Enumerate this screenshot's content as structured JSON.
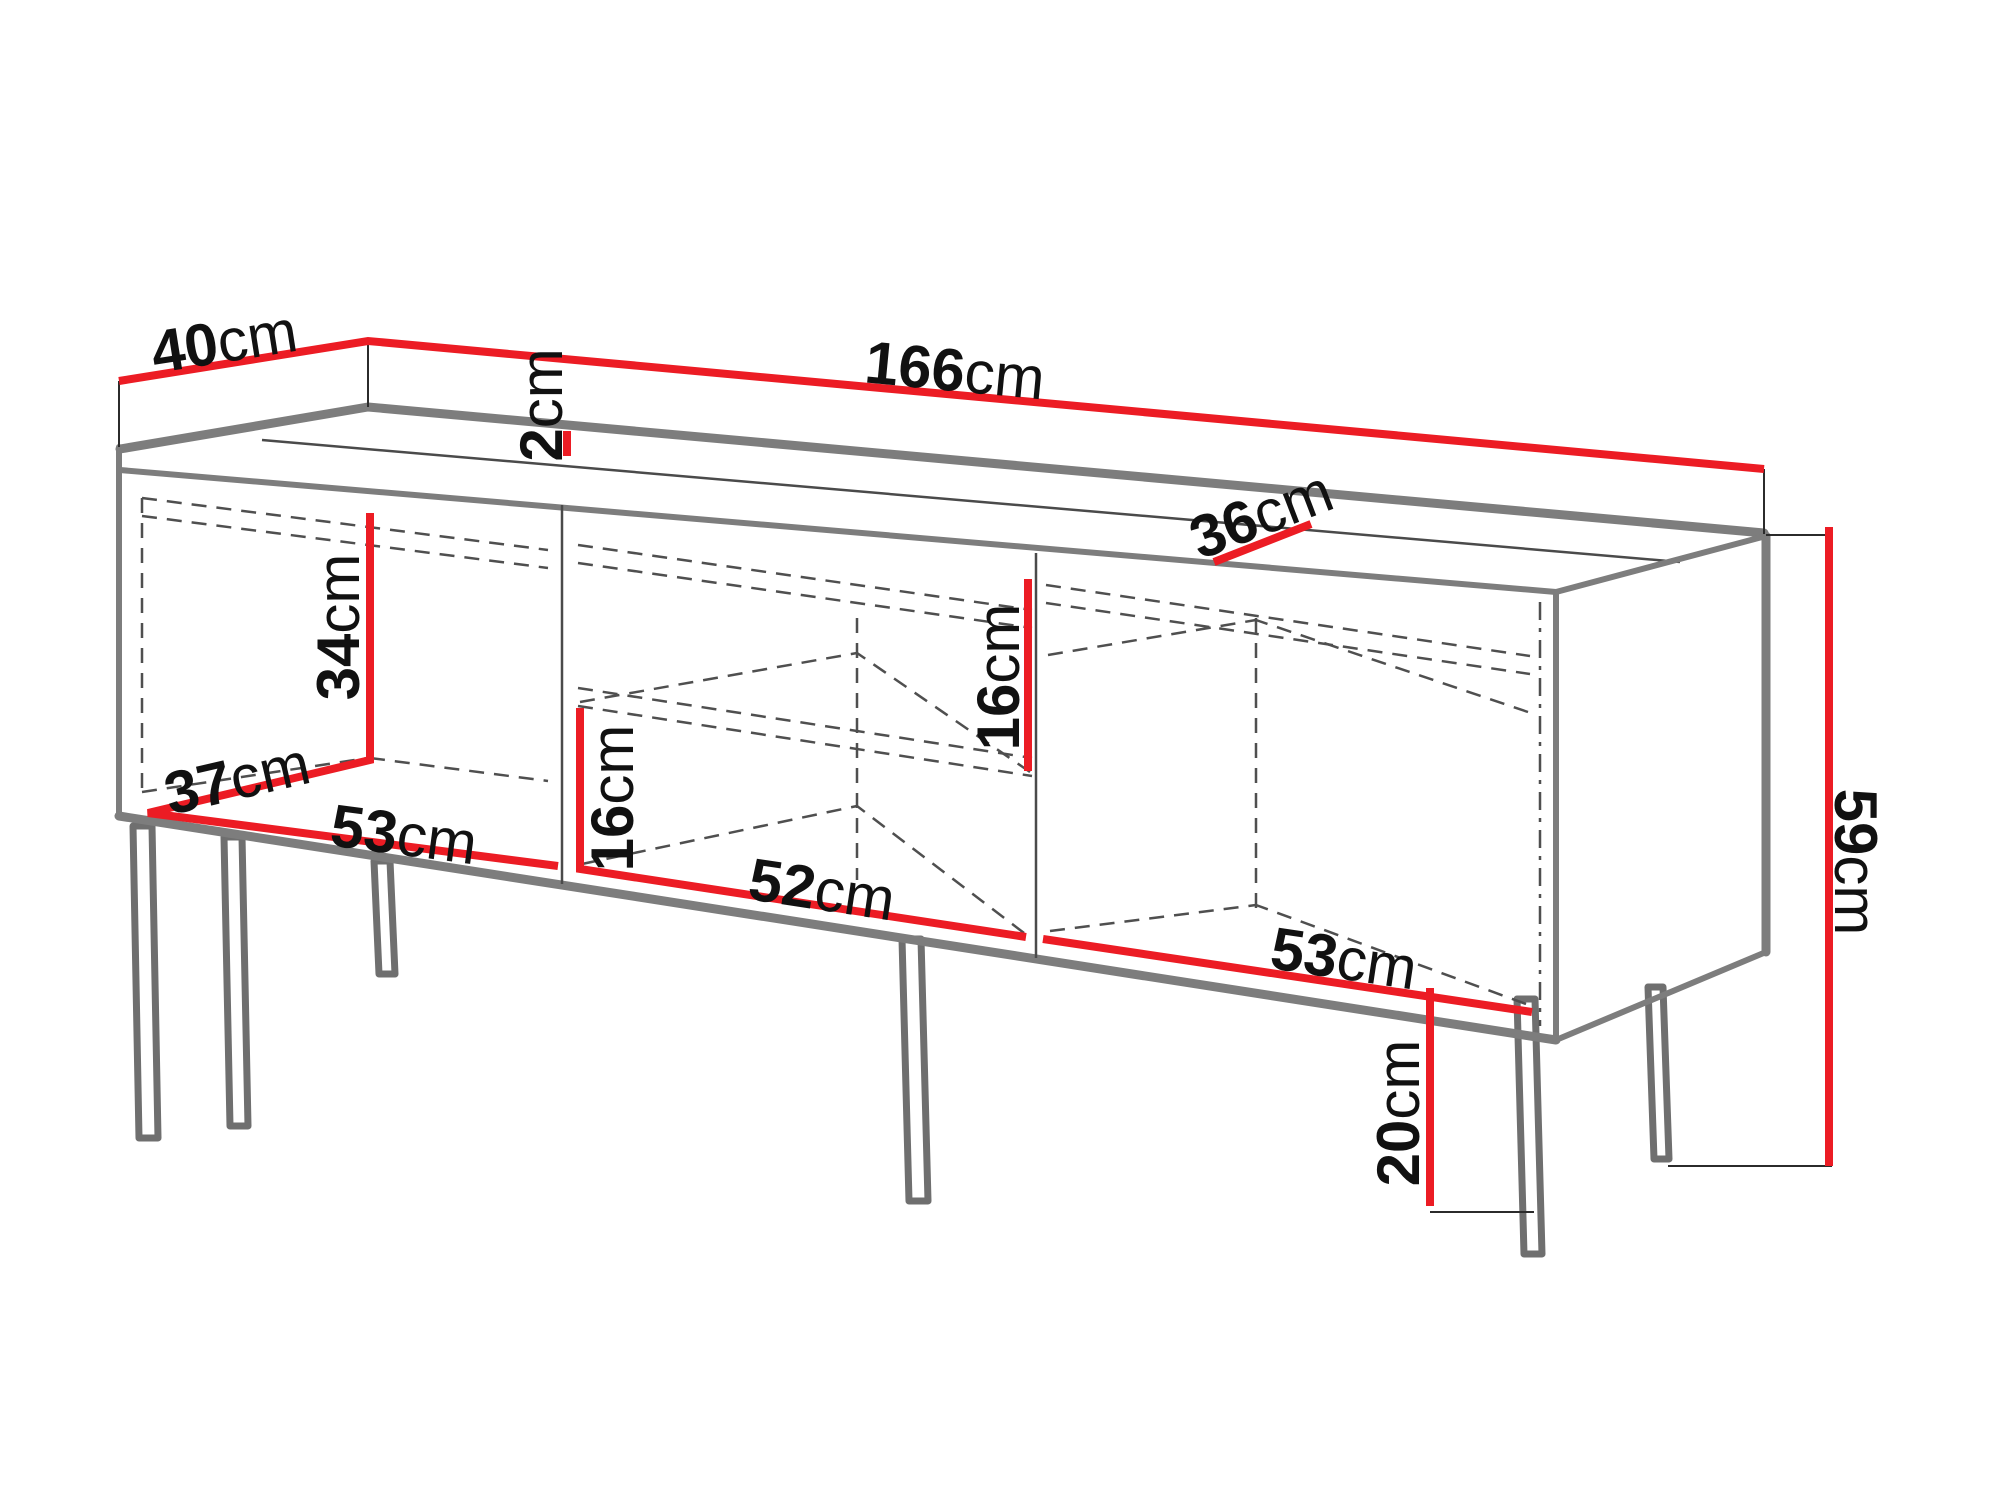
{
  "diagram": {
    "kind": "furniture-dimension-diagram",
    "subject": "TV stand / sideboard with three compartments and metal legs",
    "units": "cm",
    "colors": {
      "dimension_line": "#ec1c24",
      "cabinet_edge": "#7d7d7d",
      "hidden_edge": "#4f4f4f",
      "label_text": "#111111",
      "background": "#ffffff"
    },
    "dimensions": {
      "top_depth": {
        "value": "40",
        "unit": "cm"
      },
      "total_width": {
        "value": "166",
        "unit": "cm"
      },
      "top_panel_thickness": {
        "value": "2",
        "unit": "cm"
      },
      "top_inner_depth": {
        "value": "36",
        "unit": "cm"
      },
      "left_compartment_height": {
        "value": "34",
        "unit": "cm"
      },
      "left_compartment_depth": {
        "value": "37",
        "unit": "cm"
      },
      "left_compartment_width": {
        "value": "53",
        "unit": "cm"
      },
      "middle_lower_height": {
        "value": "16",
        "unit": "cm"
      },
      "middle_compartment_width": {
        "value": "52",
        "unit": "cm"
      },
      "middle_upper_height": {
        "value": "16",
        "unit": "cm"
      },
      "right_compartment_width": {
        "value": "53",
        "unit": "cm"
      },
      "leg_height": {
        "value": "20",
        "unit": "cm"
      },
      "total_height": {
        "value": "59",
        "unit": "cm"
      }
    }
  }
}
